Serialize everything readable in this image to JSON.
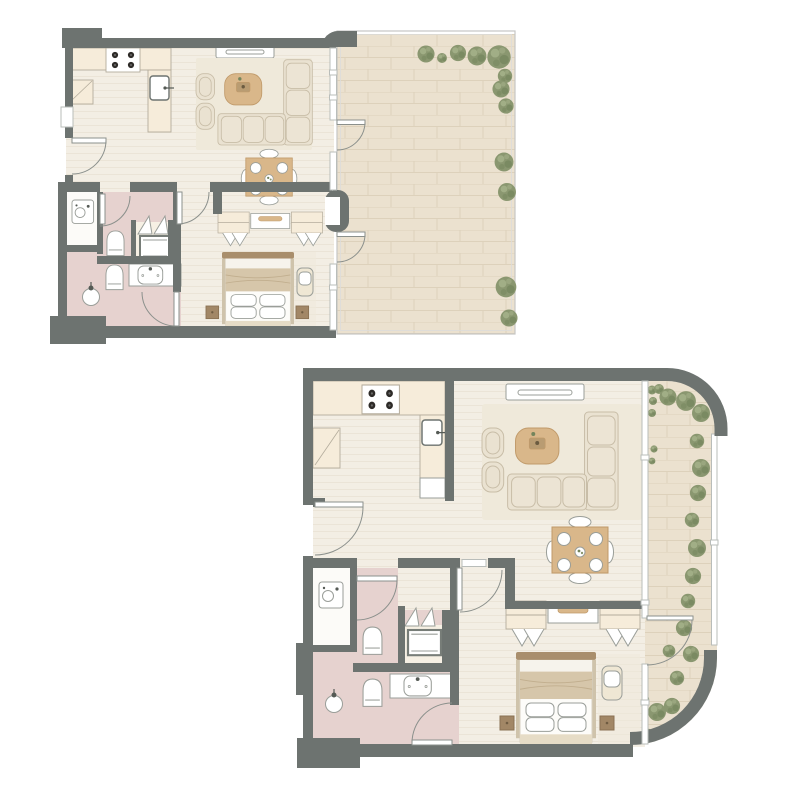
{
  "page": {
    "background": "#ffffff",
    "aria_title": "Two apartment floor plans"
  },
  "palette": {
    "wall": "#6d7370",
    "floor": "#f3eee4",
    "floor_line": "#e9e2d4",
    "rug": "#efe9da",
    "bath": "#e6d2cf",
    "niche": "#fcfbf8",
    "counter": "#f6ecda",
    "counter_line": "#b4ac9c",
    "outline": "#9a9e99",
    "terrace": "#ebe1cf",
    "terrace_line": "#ddd1bb",
    "plant": "#8a9770",
    "plant_dark": "#74855c",
    "plant_light": "#a5b189",
    "wood": "#d9b78a",
    "wood_dark": "#c09a6a",
    "sofa": "#eae2d1",
    "sofa_line": "#c8bda7",
    "white": "#ffffff",
    "bed_frame": "#a98e6c",
    "blanket": "#d6c6aa",
    "glass": "#b9bdba",
    "bench": "#efe7d4",
    "platform": "#e6dcc6",
    "nook": "#f6f0e4",
    "arc": "#8b908c"
  },
  "plans": [
    {
      "name": "upper-left-floor-plan",
      "rooms": [
        "kitchen",
        "living-dining-room",
        "hallway",
        "bathroom",
        "en-suite-bathroom",
        "bedroom",
        "terrace"
      ],
      "furniture": [
        "kitchen-counter",
        "stove",
        "kitchen-sink",
        "base-cabinet",
        "tv-console",
        "corner-sofa",
        "armchairs",
        "coffee-table",
        "dining-table-for-four",
        "wardrobes",
        "dresser",
        "double-bed",
        "bedside-tables",
        "bench",
        "washing-machine",
        "toilet",
        "toilet",
        "shower",
        "vanity-sink",
        "utility-shaft",
        "folding-closet-doors"
      ],
      "outdoor": {
        "type": "terrace",
        "shrub_count": 12
      }
    },
    {
      "name": "lower-right-floor-plan",
      "rooms": [
        "kitchen",
        "living-dining-room",
        "hallway",
        "bathroom",
        "en-suite-bathroom",
        "bedroom",
        "balcony"
      ],
      "furniture": [
        "kitchen-counter",
        "stove",
        "kitchen-sink",
        "base-cabinet",
        "tv-console",
        "corner-sofa",
        "armchairs",
        "coffee-table",
        "dining-table-for-four",
        "wardrobes",
        "dresser",
        "double-bed",
        "bedside-tables",
        "bench",
        "washing-machine",
        "toilet",
        "toilet",
        "shower",
        "vanity-sink",
        "utility-shaft",
        "folding-closet-doors"
      ],
      "outdoor": {
        "type": "curved-balcony",
        "shrub_count": 26
      }
    }
  ]
}
